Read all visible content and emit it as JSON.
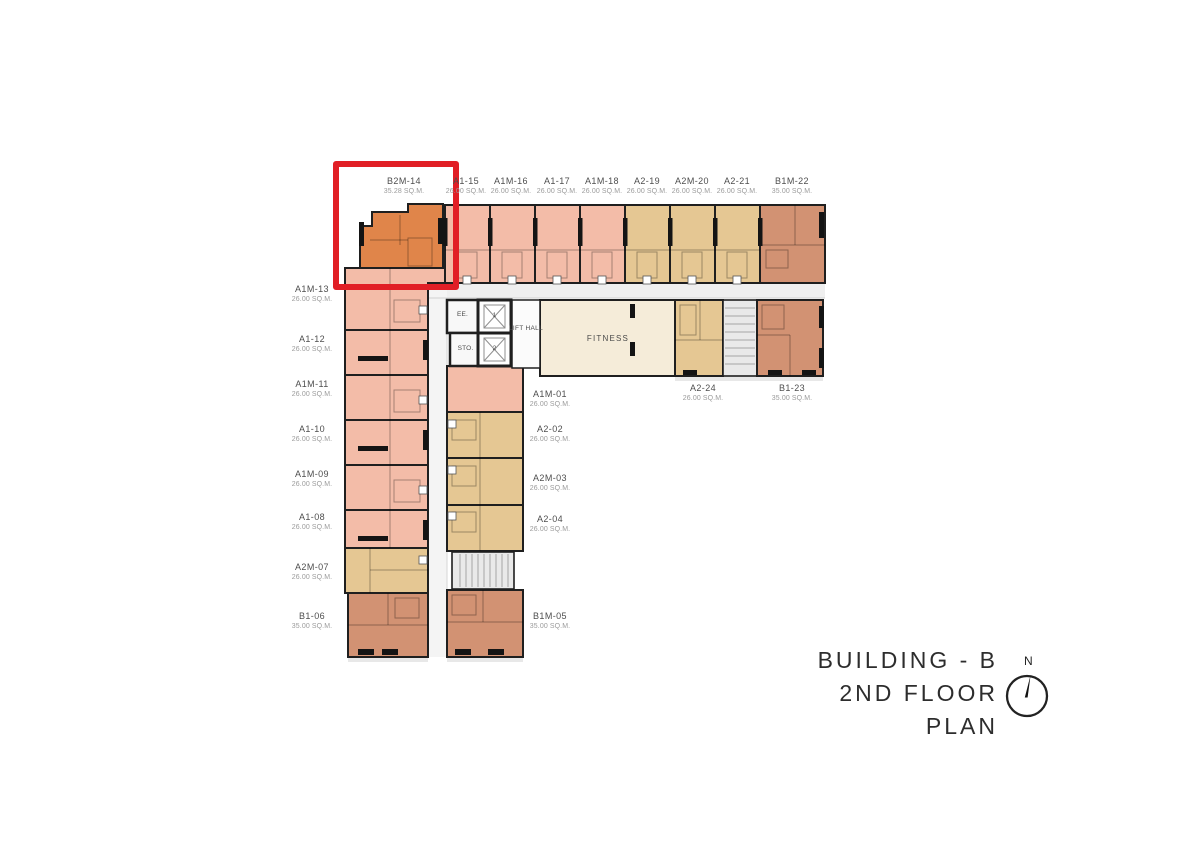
{
  "title": {
    "building": "BUILDING - B",
    "floor": "2ND FLOOR PLAN",
    "north": "N"
  },
  "highlight": {
    "unit": "B2M-14",
    "box_color": "#e11f26"
  },
  "palette": {
    "pink": "#f3bca8",
    "tan": "#e5c793",
    "brown": "#d29273",
    "orange": "#e0854a",
    "cream": "#f5ecd9",
    "corridor": "#f1f1f1",
    "stair": "#e9e9e9",
    "wall": "#1f1f1f"
  },
  "rooms": {
    "electrical": "EE.",
    "storage": "STO.",
    "lift_1": "1",
    "lift_2": "2",
    "lift_hall": "LIFT HALL",
    "fitness": "FITNESS"
  },
  "units": {
    "top": [
      {
        "id": "B2M-14",
        "area": "35.28 SQ.M."
      },
      {
        "id": "A1-15",
        "area": "26.00 SQ.M."
      },
      {
        "id": "A1M-16",
        "area": "26.00 SQ.M."
      },
      {
        "id": "A1-17",
        "area": "26.00 SQ.M."
      },
      {
        "id": "A1M-18",
        "area": "26.00 SQ.M."
      },
      {
        "id": "A2-19",
        "area": "26.00 SQ.M."
      },
      {
        "id": "A2M-20",
        "area": "26.00 SQ.M."
      },
      {
        "id": "A2-21",
        "area": "26.00 SQ.M."
      },
      {
        "id": "B1M-22",
        "area": "35.00 SQ.M."
      }
    ],
    "left": [
      {
        "id": "A1M-13",
        "area": "26.00 SQ.M."
      },
      {
        "id": "A1-12",
        "area": "26.00 SQ.M."
      },
      {
        "id": "A1M-11",
        "area": "26.00 SQ.M."
      },
      {
        "id": "A1-10",
        "area": "26.00 SQ.M."
      },
      {
        "id": "A1M-09",
        "area": "26.00 SQ.M."
      },
      {
        "id": "A1-08",
        "area": "26.00 SQ.M."
      },
      {
        "id": "A2M-07",
        "area": "26.00 SQ.M."
      },
      {
        "id": "B1-06",
        "area": "35.00 SQ.M."
      }
    ],
    "middle": [
      {
        "id": "A1M-01",
        "area": "26.00 SQ.M."
      },
      {
        "id": "A2-02",
        "area": "26.00 SQ.M."
      },
      {
        "id": "A2M-03",
        "area": "26.00 SQ.M."
      },
      {
        "id": "A2-04",
        "area": "26.00 SQ.M."
      },
      {
        "id": "B1M-05",
        "area": "35.00 SQ.M."
      }
    ],
    "right": [
      {
        "id": "A2-24",
        "area": "26.00 SQ.M."
      },
      {
        "id": "B1-23",
        "area": "35.00 SQ.M."
      }
    ]
  }
}
